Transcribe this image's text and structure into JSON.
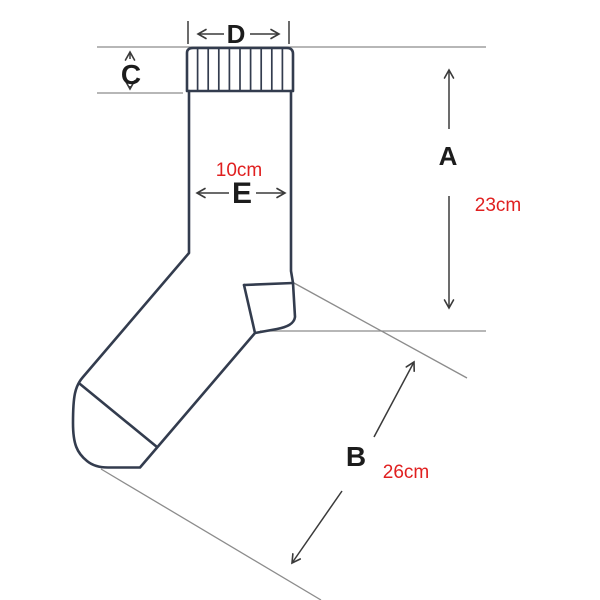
{
  "title": "Sock measurement diagram",
  "colors": {
    "background": "#ffffff",
    "outline": "#333c4e",
    "extension_line": "#8c8c8c",
    "dimension_line": "#3a3a3a",
    "label_text": "#1c1c1c",
    "value_text": "#e02020"
  },
  "dims": {
    "A": {
      "label": "A",
      "value": "23cm"
    },
    "B": {
      "label": "B",
      "value": "26cm"
    },
    "C": {
      "label": "C"
    },
    "D": {
      "label": "D"
    },
    "E": {
      "label": "E",
      "value": "10cm"
    }
  }
}
